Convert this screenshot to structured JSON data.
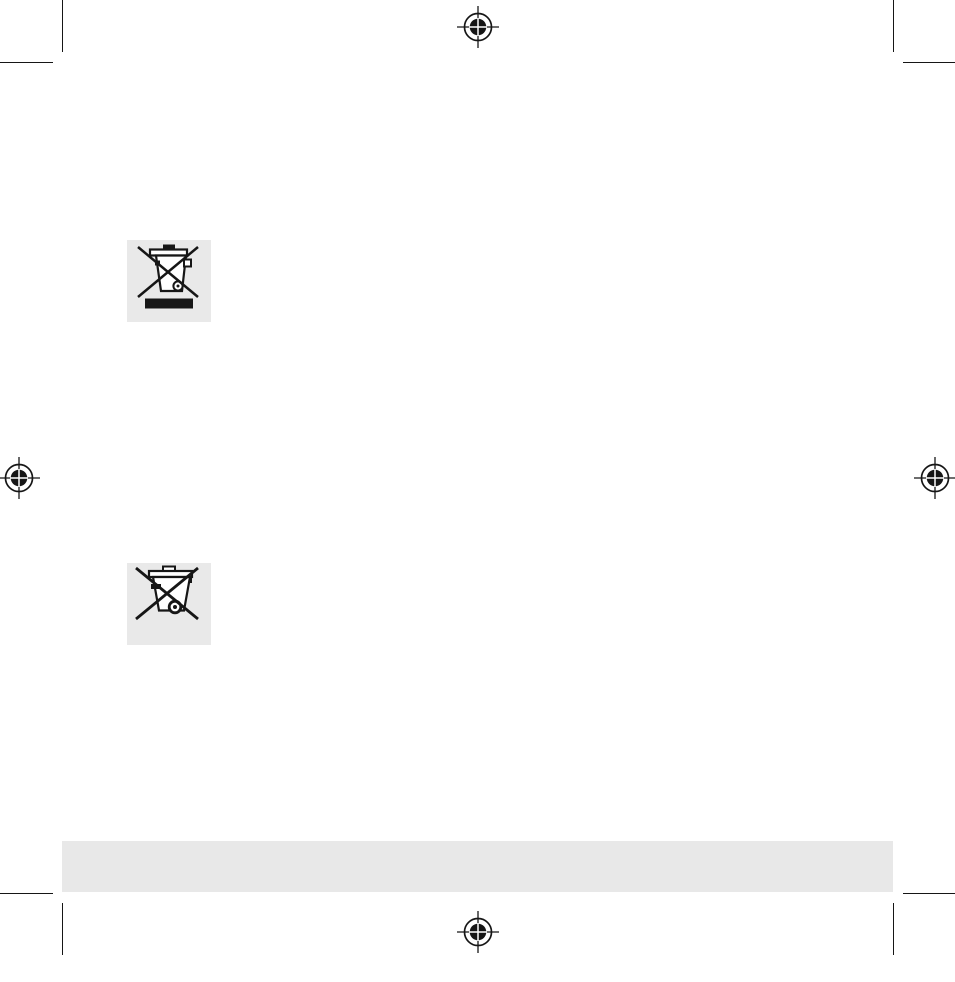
{
  "document": {
    "type": "print-layout-page",
    "description": "Blank prepress page of a product manual: corner crop marks, four registration targets, two WEEE crossed-out wheelie-bin symbols on gray squares, and an empty gray footer bar",
    "background": "#ffffff"
  },
  "colors": {
    "mark_black": "#161616",
    "symbol_box_gray": "#e9e9e9",
    "footer_bar_gray": "#e8e8e8",
    "page_background": "#ffffff"
  },
  "printer_marks": {
    "registration_targets": [
      {
        "name": "registration-mark-top-center",
        "label": "registration target top center"
      },
      {
        "name": "registration-mark-left-middle",
        "label": "registration target left middle"
      },
      {
        "name": "registration-mark-right-middle",
        "label": "registration target right middle"
      },
      {
        "name": "registration-mark-bottom-center",
        "label": "registration target bottom center"
      }
    ],
    "crop_mark_corners": [
      "top-left",
      "top-right",
      "bottom-left",
      "bottom-right"
    ]
  },
  "symbols": [
    {
      "name": "weee-bin-with-bar-icon",
      "label": "crossed-out wheeled bin with solid bar (WEEE marking)"
    },
    {
      "name": "weee-bin-icon",
      "label": "crossed-out wheeled bin (WEEE marking)"
    }
  ],
  "footer_bar": {
    "text": ""
  }
}
